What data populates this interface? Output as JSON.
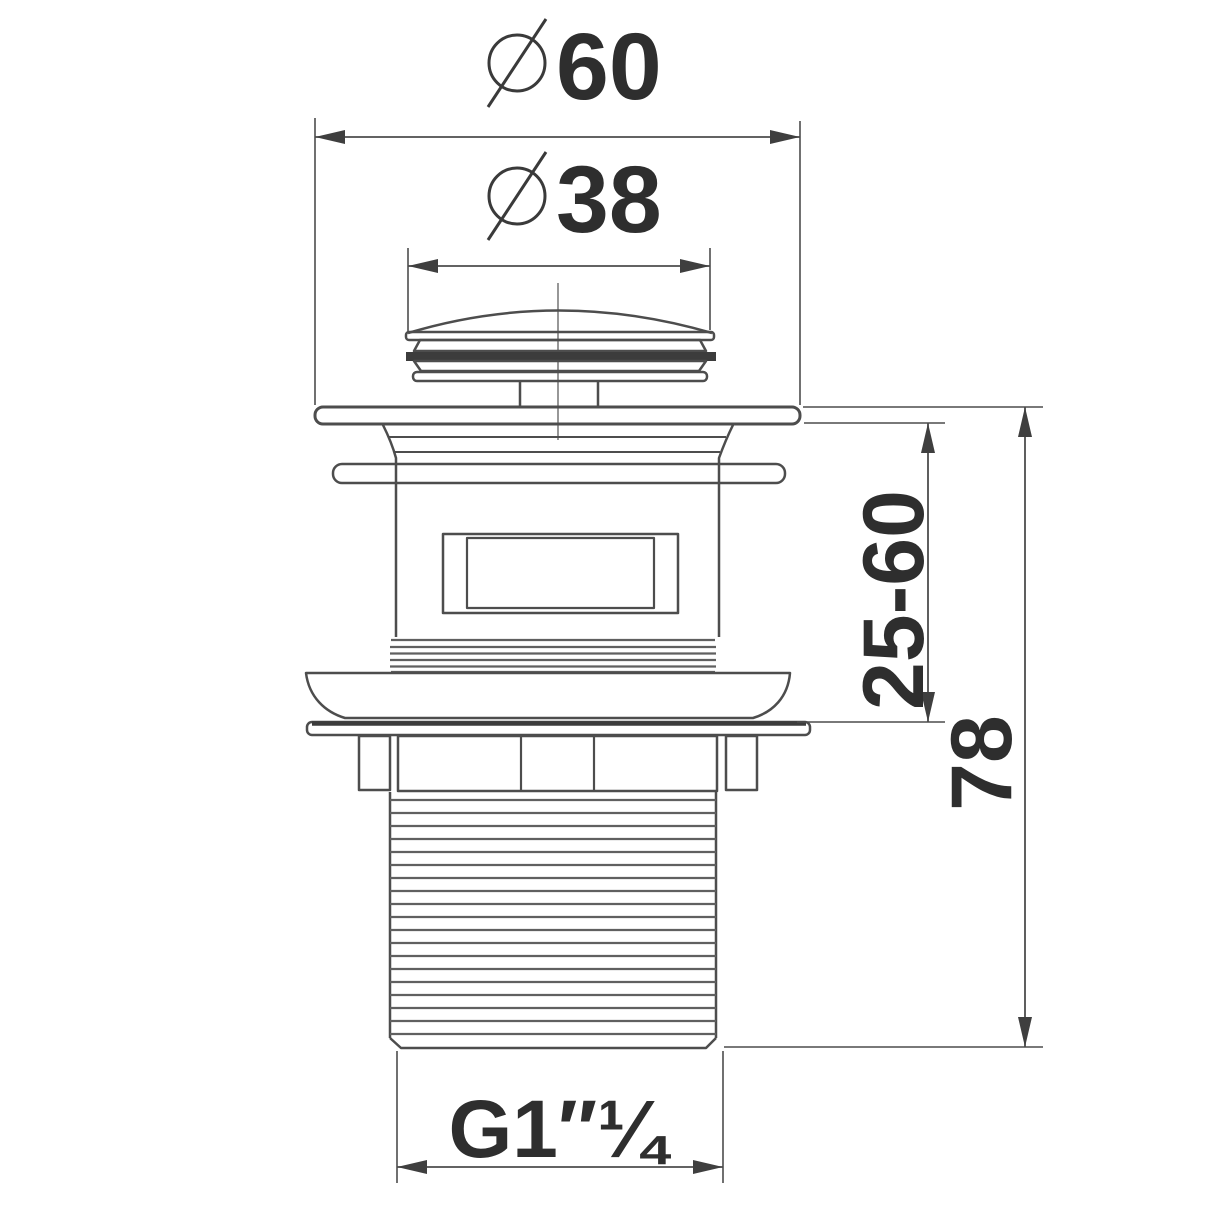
{
  "drawing": {
    "kind": "technical-dimension-drawing",
    "subject": "basin pop-up waste drain, side elevation",
    "background_color": "#ffffff",
    "line_color": "#4d4d4d",
    "text_color": "#2e2e2e",
    "dimensions": {
      "top_diameter": {
        "symbol": "Ø",
        "value": "60"
      },
      "cap_diameter": {
        "symbol": "Ø",
        "value": "38"
      },
      "clamp_range": {
        "value": "25-60"
      },
      "overall_height": {
        "value": "78"
      },
      "thread_size": {
        "value": "G1″¼"
      }
    }
  }
}
